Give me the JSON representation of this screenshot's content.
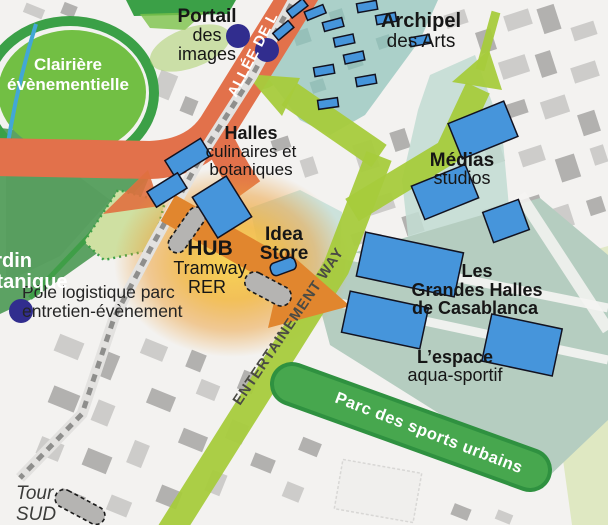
{
  "map_title": "Urban masterplan map",
  "labels": {
    "portail_line1": "Portail",
    "portail_line2": "des",
    "portail_line3": "images",
    "archipel_line1": "Archipel",
    "archipel_line2": "des Arts",
    "clairiere_line1": "Clairière",
    "clairiere_line2": "évènementielle",
    "halles_line1": "Halles",
    "halles_line2": "culinaires et",
    "halles_line3": "botaniques",
    "hub_line1": "HUB",
    "hub_line2": "Tramway",
    "hub_line3": "RER",
    "idea_line1": "Idea",
    "idea_line2": "Store",
    "medias_line1": "Médias",
    "medias_line2": "studios",
    "grandes_line1": "Les",
    "grandes_line2": "Grandes Halles",
    "grandes_line3": "de Casablanca",
    "espace_line1": "L’espace",
    "espace_line2": "aqua-sportif",
    "pole_line1": "Pôle logistique parc",
    "pole_line2": "entretien-évènement",
    "jardin_line1": "Jardin",
    "jardin_line2": "botanique",
    "tour_line1": "Tour",
    "tour_line2": "SUD",
    "allee": "ALLÉE DE L",
    "entertainment_way": "ENTERTAINEMENT WAY",
    "parc_sports": "Parc des sports urbains"
  },
  "colors": {
    "background": "#f3f2f0",
    "road_orange": "#e2714b",
    "arrow_orange": "#e1862e",
    "hub_glow": "#f8d44e",
    "green_way": "#a6cb3c",
    "parc_band": "#47a74e",
    "parc_band_edge": "#2f9140",
    "clairiere_green": "#72bf44",
    "ring_green": "#3ba047",
    "jardin_green": "#5ca263",
    "teal_zone": "#abd0c9",
    "teal_zone_light": "#c8e0d8",
    "medias_zone": "#c3dcd3",
    "halles_zone": "#b5cdc0",
    "pale_green": "#dfe8c2",
    "building_blue": "#4695db",
    "building_gray": "#cdccca",
    "building_gray_dark": "#b2b1af",
    "navy_dot": "#312d8e",
    "tram_gray": "#8e8e8c",
    "label_dark": "#161616",
    "label_white": "#ffffff",
    "way_text": "#4a4a44"
  }
}
